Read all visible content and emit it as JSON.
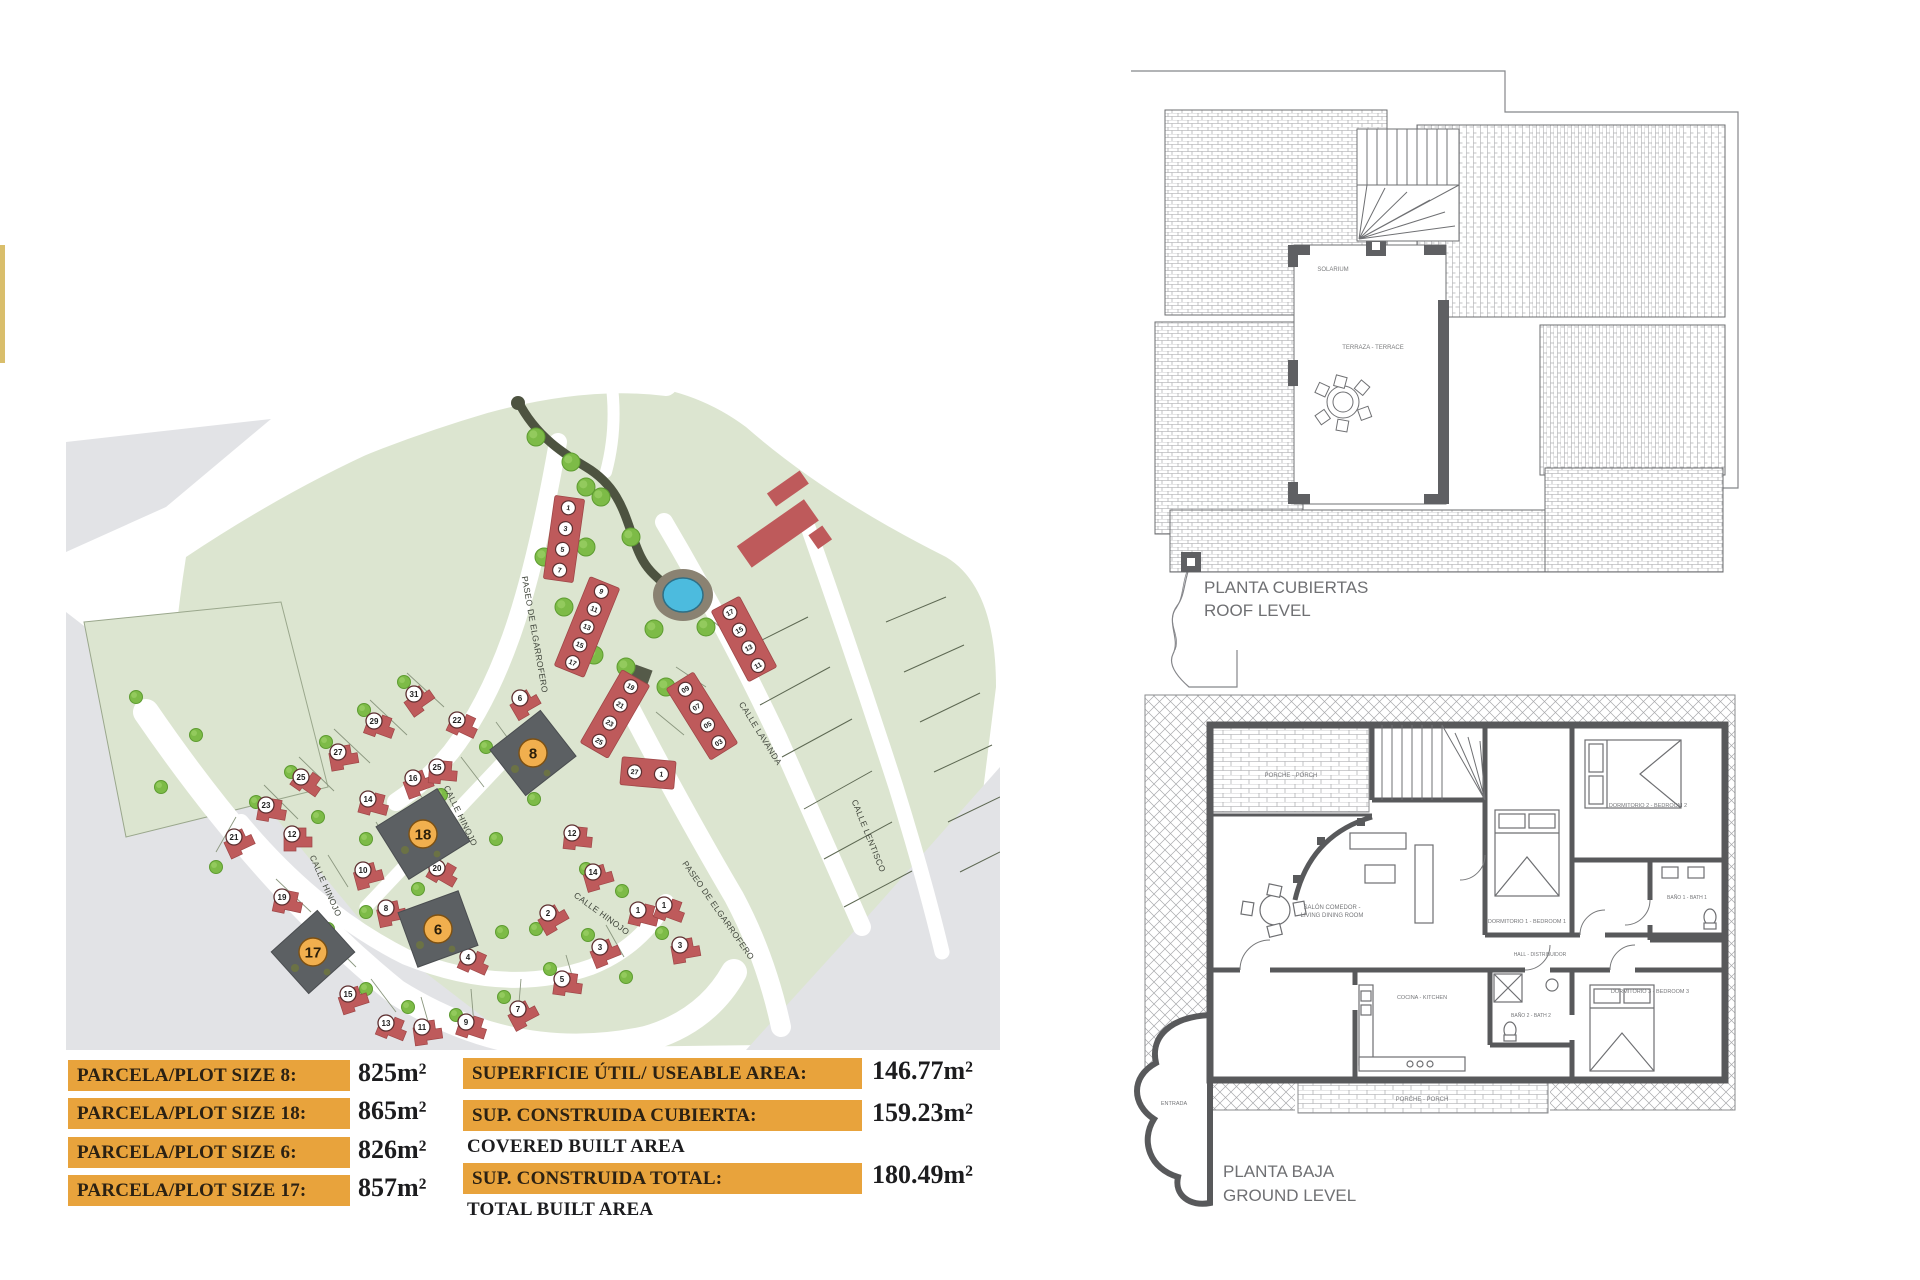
{
  "accent_bar": {
    "color": "#D9BE6B"
  },
  "tables": {
    "bar_color": "#E8A33C",
    "plot_rows": [
      {
        "label": "PARCELA/PLOT SIZE 8:",
        "value": "825m²"
      },
      {
        "label": "PARCELA/PLOT SIZE 18:",
        "value": "865m²"
      },
      {
        "label": "PARCELA/PLOT SIZE 6:",
        "value": "826m²"
      },
      {
        "label": "PARCELA/PLOT SIZE 17:",
        "value": "857m²"
      }
    ],
    "area_rows": [
      {
        "label": "SUPERFICIE ÚTIL/ USEABLE AREA:",
        "value": "146.77m²",
        "sub": ""
      },
      {
        "label": "SUP. CONSTRUIDA CUBIERTA:",
        "value": "159.23m²",
        "sub": "COVERED BUILT AREA"
      },
      {
        "label": "SUP. CONSTRUIDA TOTAL:",
        "value": "180.49m²",
        "sub": "TOTAL BUILT AREA"
      }
    ]
  },
  "roof_plan": {
    "title_line1": "PLANTA CUBIERTAS",
    "title_line2": "ROOF LEVEL",
    "labels": [
      {
        "t": "SOLARIUM",
        "x": 248,
        "y": 221,
        "s": 6
      },
      {
        "t": "TERRAZA - TERRACE",
        "x": 288,
        "y": 299,
        "s": 6
      }
    ]
  },
  "ground_plan": {
    "title_line1": "PLANTA BAJA",
    "title_line2": "GROUND LEVEL",
    "rooms": [
      {
        "t": "PORCHE - PORCH",
        "x": 181,
        "y": 92,
        "s": 6
      },
      {
        "t": "DORMITORIO 1 - BEDROOM 1",
        "x": 417,
        "y": 238,
        "s": 5.5
      },
      {
        "t": "DORMITORIO 2 - BEDROOM 2",
        "x": 538,
        "y": 122,
        "s": 5.5
      },
      {
        "t": "DORMITORIO 3 - BEDROOM 3",
        "x": 540,
        "y": 308,
        "s": 5.5
      },
      {
        "t": "BAÑO 1 - BATH 1",
        "x": 577,
        "y": 214,
        "s": 5
      },
      {
        "t": "BAÑO 2 - BATH 2",
        "x": 421,
        "y": 332,
        "s": 5
      },
      {
        "t": "HALL - DISTRIBUIDOR",
        "x": 430,
        "y": 271,
        "s": 5
      },
      {
        "t": "SALÓN COMEDOR -",
        "x": 222,
        "y": 224,
        "s": 6
      },
      {
        "t": "LIVING DINING ROOM",
        "x": 222,
        "y": 232,
        "s": 6
      },
      {
        "t": "COCINA - KITCHEN",
        "x": 312,
        "y": 314,
        "s": 5.5
      },
      {
        "t": "PORCHE - PORCH",
        "x": 312,
        "y": 416,
        "s": 6
      },
      {
        "t": "ENTRADA",
        "x": 64,
        "y": 420,
        "s": 5.5
      }
    ]
  },
  "site_plan": {
    "colors": {
      "green": "#DCE5D0",
      "gray": "#E2E3E6",
      "road": "#FFFFFF",
      "house_red": "#BE5A5B",
      "house_stroke": "#9E4647",
      "tree": "#7DBB47",
      "tree_dark": "#5E9C31",
      "pool": "#4CBBDE",
      "dark_plot": "#5C6063",
      "orange_disc": "#F1AF4E",
      "street_text": "#42473d"
    },
    "street_labels": [
      {
        "text": "PASEO DE ELGARROFERO",
        "x": 466,
        "y": 268,
        "rot": 80
      },
      {
        "text": "CALLE HINOJO",
        "x": 257,
        "y": 520,
        "rot": 66
      },
      {
        "text": "CALLE HINOJO",
        "x": 392,
        "y": 450,
        "rot": 64
      },
      {
        "text": "CALLE HINOJO",
        "x": 534,
        "y": 549,
        "rot": 36
      },
      {
        "text": "PASEO DE ELGARROFERO",
        "x": 650,
        "y": 545,
        "rot": 55
      },
      {
        "text": "CALLE LAVANDA",
        "x": 692,
        "y": 368,
        "rot": 58
      },
      {
        "text": "CALLE LENTISCO",
        "x": 800,
        "y": 470,
        "rot": 68
      }
    ],
    "highlight_plots": [
      {
        "n": "8",
        "x": 467,
        "y": 386,
        "w": 64,
        "h": 58,
        "rot": -38
      },
      {
        "n": "18",
        "x": 357,
        "y": 467,
        "w": 72,
        "h": 62,
        "rot": -32
      },
      {
        "n": "6",
        "x": 372,
        "y": 562,
        "w": 64,
        "h": 58,
        "rot": -20
      },
      {
        "n": "17",
        "x": 247,
        "y": 585,
        "w": 62,
        "h": 56,
        "rot": -42
      }
    ],
    "lots": [
      {
        "n": "21",
        "x": 168,
        "y": 470,
        "rot": -25
      },
      {
        "n": "23",
        "x": 200,
        "y": 438,
        "rot": 10
      },
      {
        "n": "25",
        "x": 235,
        "y": 410,
        "rot": 35
      },
      {
        "n": "27",
        "x": 272,
        "y": 385,
        "rot": -10
      },
      {
        "n": "29",
        "x": 308,
        "y": 354,
        "rot": 20
      },
      {
        "n": "31",
        "x": 348,
        "y": 327,
        "rot": -35
      },
      {
        "n": "12",
        "x": 226,
        "y": 467,
        "rot": 0
      },
      {
        "n": "14",
        "x": 302,
        "y": 432,
        "rot": 15
      },
      {
        "n": "16",
        "x": 347,
        "y": 411,
        "rot": -20
      },
      {
        "n": "22",
        "x": 391,
        "y": 353,
        "rot": 25
      },
      {
        "n": "10",
        "x": 297,
        "y": 503,
        "rot": -15
      },
      {
        "n": "20",
        "x": 371,
        "y": 501,
        "rot": 30
      },
      {
        "n": "25",
        "x": 371,
        "y": 400,
        "rot": 5
      },
      {
        "n": "6",
        "x": 454,
        "y": 331,
        "rot": -30
      },
      {
        "n": "19",
        "x": 216,
        "y": 530,
        "rot": 12
      },
      {
        "n": "15",
        "x": 282,
        "y": 627,
        "rot": -18
      },
      {
        "n": "13",
        "x": 320,
        "y": 656,
        "rot": 22
      },
      {
        "n": "11",
        "x": 356,
        "y": 660,
        "rot": -8
      },
      {
        "n": "9",
        "x": 400,
        "y": 655,
        "rot": 18
      },
      {
        "n": "7",
        "x": 452,
        "y": 642,
        "rot": -28
      },
      {
        "n": "5",
        "x": 496,
        "y": 612,
        "rot": 8
      },
      {
        "n": "3",
        "x": 534,
        "y": 580,
        "rot": -22
      },
      {
        "n": "1",
        "x": 572,
        "y": 543,
        "rot": 14
      },
      {
        "n": "8",
        "x": 320,
        "y": 541,
        "rot": -12
      },
      {
        "n": "4",
        "x": 402,
        "y": 590,
        "rot": 24
      },
      {
        "n": "2",
        "x": 482,
        "y": 546,
        "rot": -30
      },
      {
        "n": "12",
        "x": 506,
        "y": 466,
        "rot": 6
      },
      {
        "n": "14",
        "x": 527,
        "y": 505,
        "rot": -16
      },
      {
        "n": "1",
        "x": 598,
        "y": 538,
        "rot": 20
      },
      {
        "n": "3",
        "x": 614,
        "y": 578,
        "rot": -10
      }
    ],
    "terrace_blocks": [
      {
        "cx": 498,
        "cy": 172,
        "w": 30,
        "h": 84,
        "rot": 8,
        "discs": [
          "1",
          "3",
          "5",
          "7"
        ]
      },
      {
        "cx": 521,
        "cy": 260,
        "w": 32,
        "h": 96,
        "rot": 22,
        "discs": [
          "9",
          "11",
          "13",
          "15",
          "17"
        ]
      },
      {
        "cx": 549,
        "cy": 347,
        "w": 32,
        "h": 84,
        "rot": 30,
        "discs": [
          "19",
          "21",
          "23",
          "25"
        ]
      },
      {
        "cx": 582,
        "cy": 406,
        "w": 54,
        "h": 28,
        "rot": 5,
        "horiz": true,
        "discs": [
          "27",
          "1"
        ]
      },
      {
        "cx": 636,
        "cy": 349,
        "w": 32,
        "h": 84,
        "rot": -32,
        "discs": [
          "09",
          "07",
          "05",
          "03"
        ]
      },
      {
        "cx": 678,
        "cy": 272,
        "w": 32,
        "h": 80,
        "rot": -28,
        "discs": [
          "17",
          "15",
          "13",
          "11"
        ]
      }
    ],
    "trees": [
      [
        150,
        500
      ],
      [
        190,
        435
      ],
      [
        225,
        405
      ],
      [
        260,
        375
      ],
      [
        298,
        343
      ],
      [
        338,
        315
      ],
      [
        252,
        450
      ],
      [
        300,
        472
      ],
      [
        344,
        480
      ],
      [
        375,
        428
      ],
      [
        420,
        380
      ],
      [
        300,
        545
      ],
      [
        262,
        562
      ],
      [
        300,
        622
      ],
      [
        342,
        640
      ],
      [
        390,
        648
      ],
      [
        438,
        630
      ],
      [
        484,
        602
      ],
      [
        522,
        568
      ],
      [
        436,
        565
      ],
      [
        352,
        522
      ],
      [
        430,
        472
      ],
      [
        468,
        432
      ],
      [
        520,
        502
      ],
      [
        556,
        524
      ],
      [
        470,
        562
      ],
      [
        596,
        566
      ],
      [
        560,
        610
      ],
      [
        70,
        330
      ],
      [
        130,
        368
      ],
      [
        95,
        420
      ]
    ],
    "park_trees": [
      [
        470,
        70
      ],
      [
        505,
        95
      ],
      [
        535,
        130
      ],
      [
        565,
        170
      ],
      [
        588,
        262
      ],
      [
        560,
        300
      ],
      [
        528,
        288
      ],
      [
        498,
        240
      ],
      [
        478,
        190
      ],
      [
        520,
        180
      ],
      [
        640,
        260
      ],
      [
        600,
        320
      ],
      [
        520,
        120
      ]
    ],
    "plot_lines": [
      [
        198,
        418,
        232,
        452
      ],
      [
        233,
        390,
        268,
        424
      ],
      [
        268,
        362,
        304,
        396
      ],
      [
        304,
        333,
        341,
        368
      ],
      [
        341,
        306,
        378,
        340
      ],
      [
        170,
        450,
        150,
        485
      ],
      [
        210,
        512,
        245,
        545
      ],
      [
        258,
        568,
        290,
        600
      ],
      [
        305,
        612,
        330,
        645
      ],
      [
        355,
        630,
        365,
        665
      ],
      [
        405,
        622,
        408,
        658
      ],
      [
        455,
        612,
        452,
        648
      ],
      [
        500,
        588,
        510,
        622
      ],
      [
        540,
        558,
        558,
        590
      ],
      [
        430,
        355,
        452,
        385
      ],
      [
        395,
        390,
        418,
        420
      ],
      [
        352,
        425,
        374,
        455
      ],
      [
        310,
        455,
        330,
        488
      ],
      [
        262,
        488,
        282,
        520
      ],
      [
        610,
        300,
        640,
        320
      ],
      [
        648,
        255,
        676,
        278
      ],
      [
        590,
        345,
        618,
        368
      ]
    ],
    "grid_lines": [
      [
        672,
        285,
        742,
        250
      ],
      [
        694,
        338,
        764,
        300
      ],
      [
        716,
        390,
        786,
        352
      ],
      [
        738,
        442,
        806,
        404
      ],
      [
        758,
        492,
        826,
        455
      ],
      [
        778,
        540,
        846,
        504
      ],
      [
        820,
        255,
        880,
        230
      ],
      [
        838,
        305,
        898,
        278
      ],
      [
        854,
        355,
        914,
        326
      ],
      [
        868,
        405,
        926,
        378
      ],
      [
        882,
        455,
        934,
        430
      ],
      [
        894,
        505,
        934,
        485
      ]
    ]
  }
}
